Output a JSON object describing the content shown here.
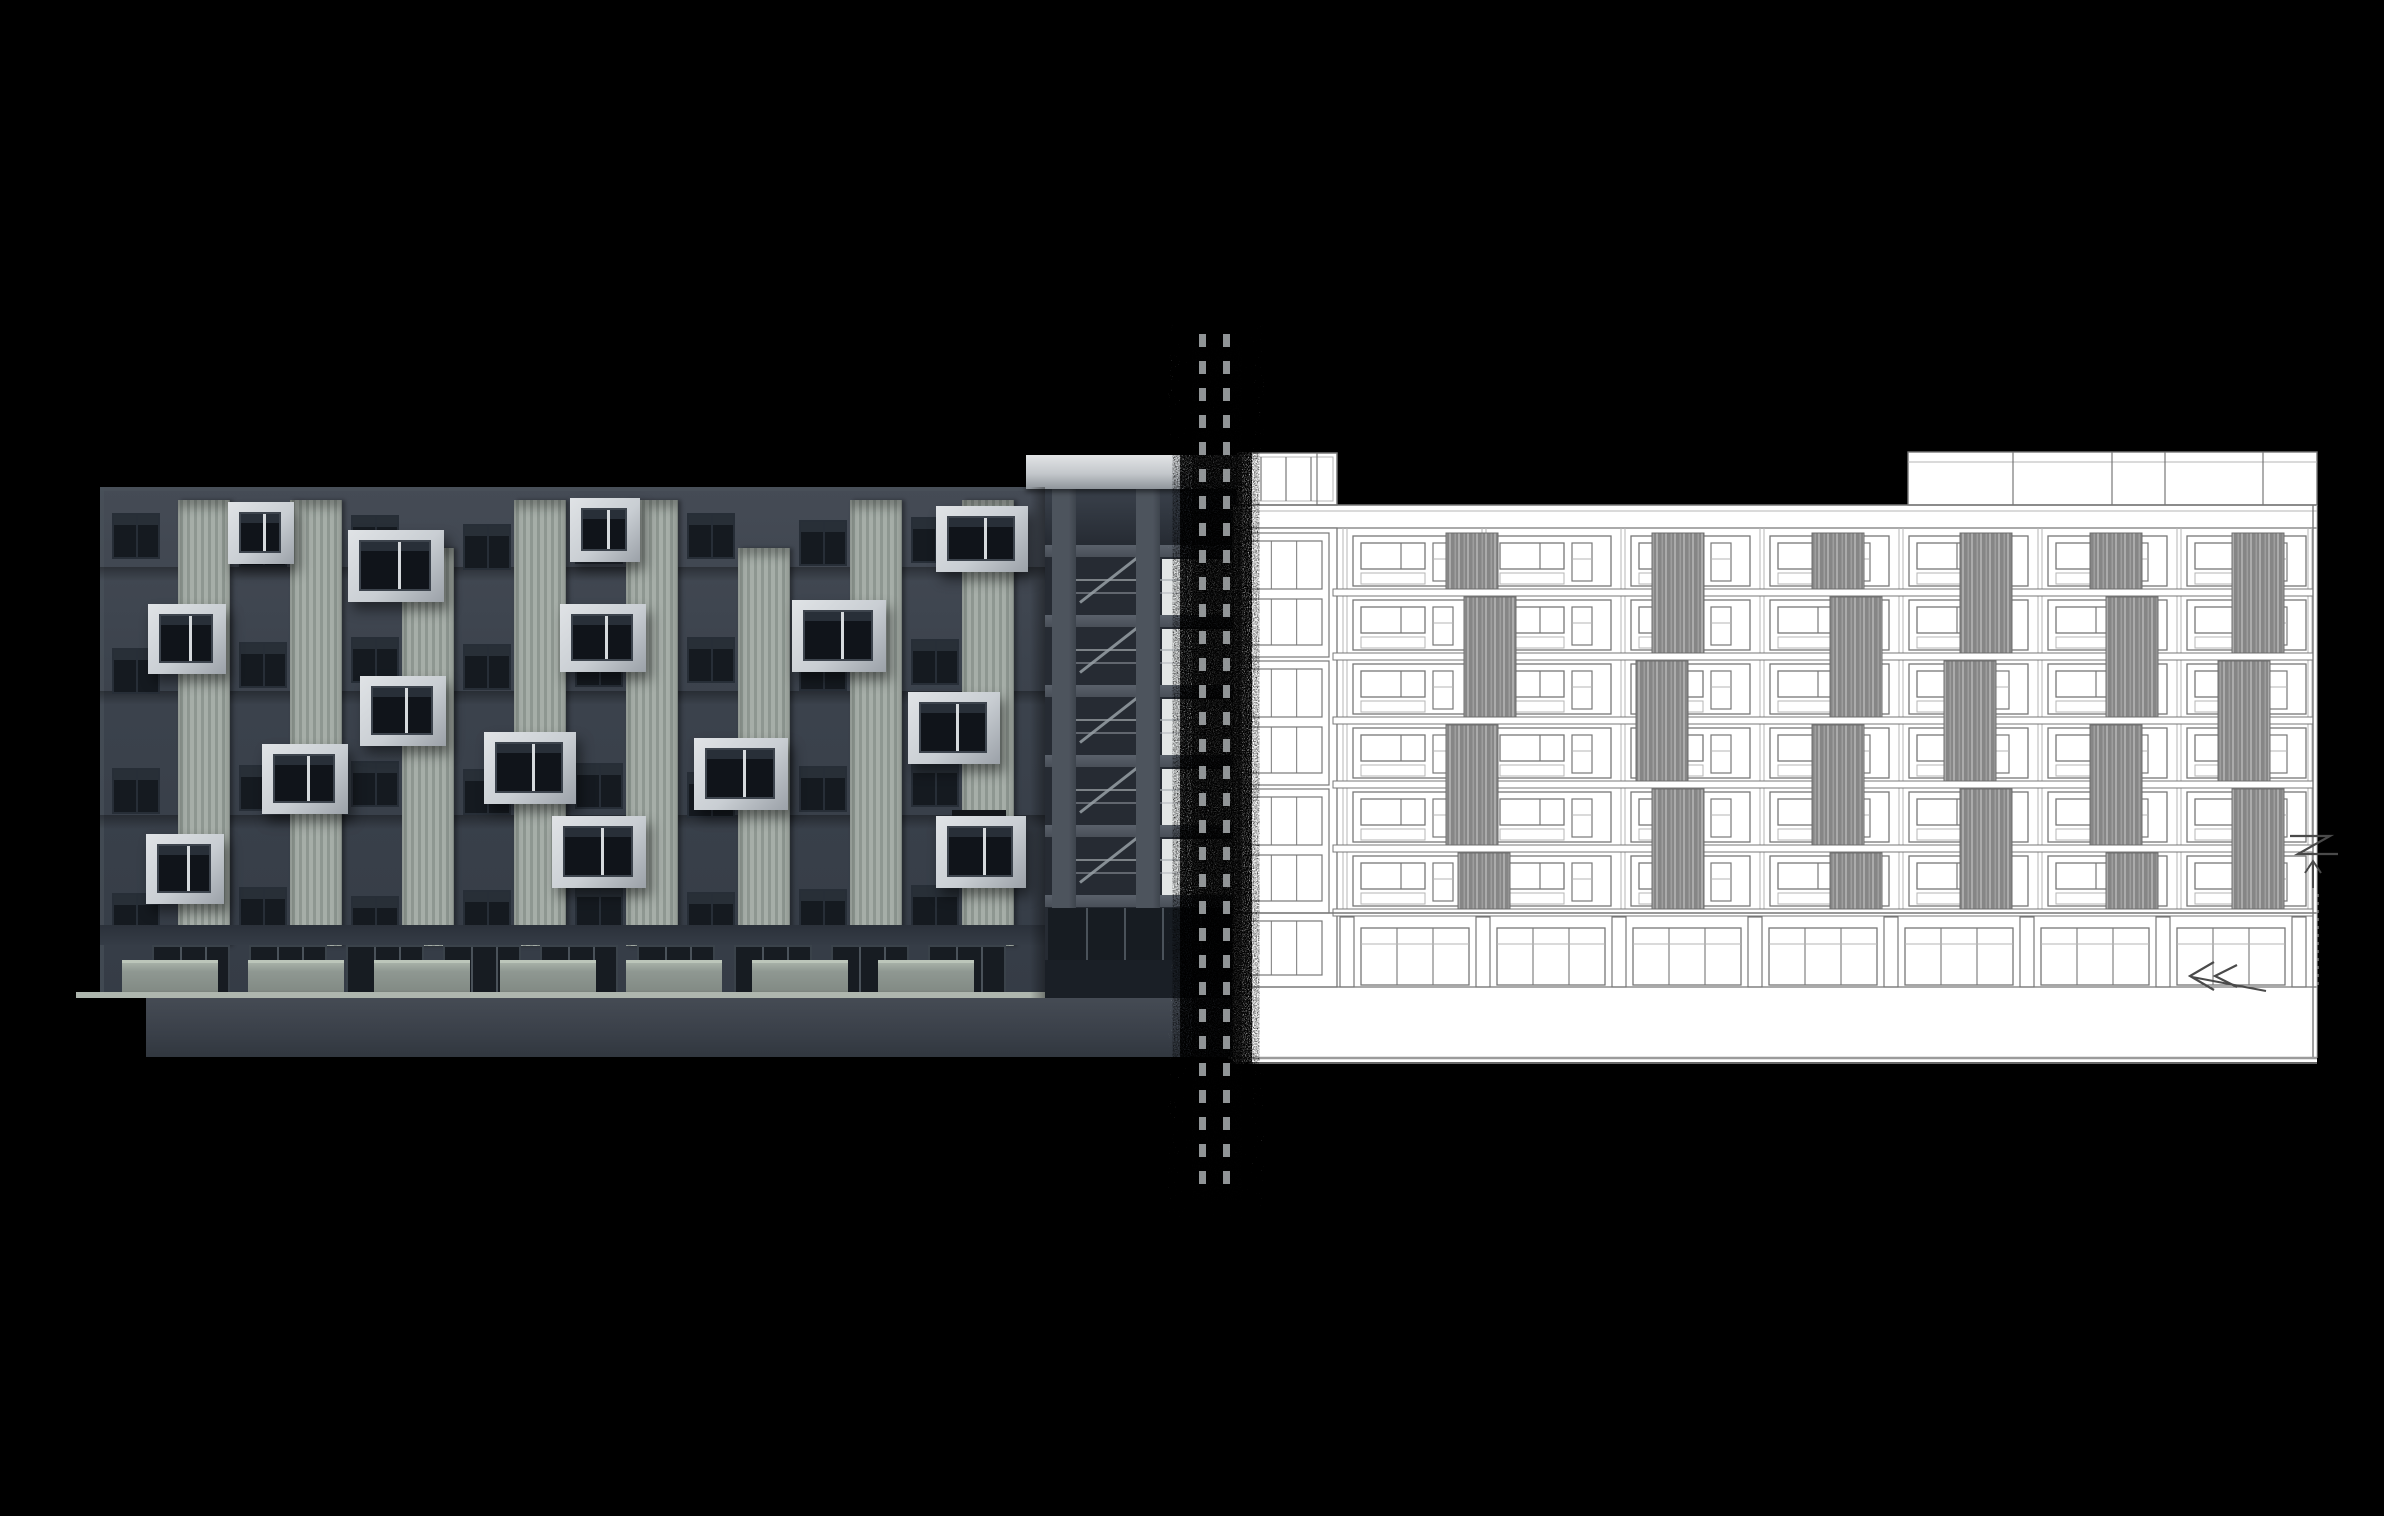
{
  "scene": {
    "width": 2384,
    "height": 1516,
    "background": "#000000",
    "description": "Architectural elevation comparison sheet: dark photorealistic 3D render of an apartment block on the left, matching white CAD line-art elevation on the right, joined by a vertical double-dashed match line with grain texture"
  },
  "divider": {
    "dash_color": "#989C9E",
    "lines_x": [
      1199,
      1223
    ],
    "line_width": 7,
    "dash_length": 13,
    "dash_gap": 14,
    "y_top": 334,
    "y_height": 862,
    "noise_color": "#0A0A0A",
    "speckle_color": "#FFFFFF"
  },
  "left_render": {
    "type": "photorealistic-3d-render",
    "palette": {
      "facade_top": "#454B55",
      "facade": "#3C434D",
      "facade_low": "#353C46",
      "slab_shadow": "#2E343D",
      "window_glass": "#151A20",
      "window_frame": "#272E37",
      "window_sky": "#39414B",
      "louver_a": "#A6AEA8",
      "louver_b": "#8E9791",
      "box_face": "#C9CED3",
      "box_light": "#E0E3E6",
      "box_shade": "#9BA1A8",
      "box_glass": "#10141A",
      "mullion": "#D6DADD",
      "storefront_glass": "#171C22",
      "storefront_mullion": "#4A525A",
      "header_band": "#2B313A",
      "planter": "#8F9892",
      "planter_top": "#AFB9AE",
      "ledge": "#AEB6AE",
      "plinth_hi": "#454B54",
      "plinth_lo": "#3A4049",
      "balcony_bg": "#262B33",
      "pier": "#4D545D",
      "slab_edge": "#5A616B",
      "bright_window": "#E3E6E6",
      "rail": "#AAB0B5",
      "stair": "#98A0A6",
      "roof_hi": "#E2E4E6",
      "roof_lo": "#8F959B",
      "roof_band": "#31373F",
      "sign": "#14171B",
      "edge_highlight": "#4A515A"
    },
    "facade": {
      "x": 100,
      "y": 487,
      "w": 945,
      "h": 511
    },
    "window_rows": [
      513,
      637,
      761,
      885
    ],
    "window_h": 46,
    "window_w": 48,
    "window_cols": [
      112,
      239,
      351,
      463,
      575,
      687,
      799,
      911
    ],
    "row_jitter": [
      0,
      14,
      4,
      18,
      8,
      0,
      12,
      6
    ],
    "slab_ys": [
      567,
      691,
      815
    ],
    "louver_w": 52,
    "louvers": [
      {
        "x": 178,
        "y": 500,
        "h": 446
      },
      {
        "x": 290,
        "y": 500,
        "h": 446
      },
      {
        "x": 402,
        "y": 548,
        "h": 398
      },
      {
        "x": 514,
        "y": 500,
        "h": 446
      },
      {
        "x": 626,
        "y": 500,
        "h": 446
      },
      {
        "x": 738,
        "y": 548,
        "h": 398
      },
      {
        "x": 850,
        "y": 500,
        "h": 446
      },
      {
        "x": 962,
        "y": 500,
        "h": 446
      }
    ],
    "box_windows": [
      {
        "x": 228,
        "y": 502,
        "w": 66,
        "h": 62
      },
      {
        "x": 570,
        "y": 498,
        "w": 70,
        "h": 64
      },
      {
        "x": 936,
        "y": 506,
        "w": 92,
        "h": 66
      },
      {
        "x": 348,
        "y": 530,
        "w": 96,
        "h": 72
      },
      {
        "x": 148,
        "y": 604,
        "w": 78,
        "h": 70
      },
      {
        "x": 560,
        "y": 604,
        "w": 86,
        "h": 68
      },
      {
        "x": 792,
        "y": 600,
        "w": 94,
        "h": 72
      },
      {
        "x": 360,
        "y": 676,
        "w": 86,
        "h": 70
      },
      {
        "x": 908,
        "y": 692,
        "w": 92,
        "h": 72
      },
      {
        "x": 262,
        "y": 744,
        "w": 86,
        "h": 70
      },
      {
        "x": 484,
        "y": 732,
        "w": 92,
        "h": 72
      },
      {
        "x": 694,
        "y": 738,
        "w": 94,
        "h": 72
      },
      {
        "x": 552,
        "y": 816,
        "w": 94,
        "h": 72
      },
      {
        "x": 146,
        "y": 834,
        "w": 78,
        "h": 70
      },
      {
        "x": 936,
        "y": 816,
        "w": 90,
        "h": 72
      }
    ],
    "sign": {
      "x": 952,
      "y": 810,
      "w": 54,
      "h": 14
    },
    "ground": {
      "header_y": 925,
      "header_h": 20,
      "storefront_y": 945,
      "storefront_h": 53,
      "unit_xs": [
        152,
        249,
        346,
        443,
        540,
        637,
        734,
        831,
        928
      ],
      "unit_w": 78,
      "planter_xs": [
        122,
        248,
        374,
        500,
        626,
        752,
        878
      ],
      "planter_w": 96,
      "planter_y": 960,
      "planter_h": 38,
      "ledge": {
        "x": 76,
        "y": 992,
        "w": 970,
        "h": 6
      },
      "plinth": {
        "x": 146,
        "y": 998,
        "w": 1098,
        "h": 59
      }
    },
    "balcony": {
      "x": 1045,
      "w": 198,
      "top": 489,
      "roof_slab": {
        "x": 1026,
        "y": 455,
        "w": 217,
        "h": 34
      },
      "floor_ys": [
        545,
        615,
        685,
        755,
        825,
        895
      ],
      "slab_h": 12,
      "piers": [
        {
          "x": 1052,
          "w": 24
        },
        {
          "x": 1136,
          "w": 24
        }
      ],
      "window_col": {
        "x": 1162,
        "w": 76
      },
      "rail_x1": 1076,
      "rail_x2": 1238,
      "ground_glass": {
        "y": 908,
        "h": 52
      }
    }
  },
  "elevation_drawing": {
    "type": "cad-line-elevation",
    "paper": "#FFFFFF",
    "ink": "#777777",
    "ink_light": "#B5B5B5",
    "ink_dark": "#4A4A4A",
    "ink_mid": "#9B9B9B",
    "hatch_base": "#868686",
    "hatch_hi": "#ABABAB",
    "sheet": {
      "x": 1233,
      "y": 505,
      "w": 1084,
      "h": 557
    },
    "parapet": {
      "y1": 505,
      "y2": 528
    },
    "rooftop_left": {
      "x": 1237,
      "y": 453,
      "w": 100,
      "h": 52,
      "mullions": [
        1261,
        1286,
        1311
      ]
    },
    "rooftop_right": {
      "x": 1908,
      "y": 452,
      "w": 409,
      "h": 53,
      "dividers": [
        2013,
        2112,
        2165,
        2263
      ]
    },
    "stair_column": {
      "x": 1237,
      "w": 96,
      "unit_ys": [
        533,
        661,
        789
      ],
      "unit_h": 124,
      "base_y": 913,
      "base_h": 70
    },
    "rows": [
      533,
      597,
      661,
      725,
      789,
      853
    ],
    "row_h": 56,
    "cols": [
      1348,
      1487,
      1626,
      1765,
      1904,
      2043,
      2182
    ],
    "col_w": 131,
    "slab_ys": [
      589,
      653,
      717,
      781,
      845,
      909
    ],
    "strip_w": 52,
    "louver_strips": [
      {
        "x": 1446,
        "y": 533,
        "h": 56
      },
      {
        "x": 1464,
        "y": 597,
        "h": 120
      },
      {
        "x": 1446,
        "y": 725,
        "h": 120
      },
      {
        "x": 1458,
        "y": 853,
        "h": 56
      },
      {
        "x": 1652,
        "y": 533,
        "h": 120
      },
      {
        "x": 1636,
        "y": 661,
        "h": 120
      },
      {
        "x": 1652,
        "y": 789,
        "h": 120
      },
      {
        "x": 1812,
        "y": 533,
        "h": 56
      },
      {
        "x": 1830,
        "y": 597,
        "h": 120
      },
      {
        "x": 1812,
        "y": 725,
        "h": 120
      },
      {
        "x": 1830,
        "y": 853,
        "h": 56
      },
      {
        "x": 1960,
        "y": 533,
        "h": 120
      },
      {
        "x": 1944,
        "y": 661,
        "h": 120
      },
      {
        "x": 1960,
        "y": 789,
        "h": 120
      },
      {
        "x": 2090,
        "y": 533,
        "h": 56
      },
      {
        "x": 2106,
        "y": 597,
        "h": 120
      },
      {
        "x": 2090,
        "y": 725,
        "h": 120
      },
      {
        "x": 2106,
        "y": 853,
        "h": 56
      },
      {
        "x": 2232,
        "y": 533,
        "h": 120
      },
      {
        "x": 2218,
        "y": 661,
        "h": 120
      },
      {
        "x": 2232,
        "y": 789,
        "h": 120
      }
    ],
    "storefront": {
      "band_y": 913,
      "band_h": 74,
      "glass_y": 928,
      "glass_h": 57,
      "transom_y": 944,
      "pier_xs": [
        1340,
        1476,
        1612,
        1748,
        1884,
        2020,
        2156,
        2292
      ],
      "pier_w": 14
    },
    "ground_line_y": 1058,
    "right_edge_x": 2313,
    "annotations": {
      "zigzag": [
        [
          2290,
          836
        ],
        [
          2330,
          836
        ],
        [
          2298,
          854
        ],
        [
          2338,
          854
        ]
      ],
      "arrow_up": {
        "x": 2313,
        "y1": 888,
        "y2": 861
      },
      "hidden_line": {
        "x": 2318,
        "y1": 894,
        "y2": 988
      },
      "chevron_a": [
        [
          2214,
          962
        ],
        [
          2190,
          976
        ],
        [
          2214,
          990
        ]
      ],
      "chevron_b": [
        [
          2237,
          965
        ],
        [
          2215,
          976
        ],
        [
          2237,
          987
        ]
      ],
      "tail": [
        [
          2192,
          977
        ],
        [
          2266,
          991
        ]
      ]
    }
  }
}
